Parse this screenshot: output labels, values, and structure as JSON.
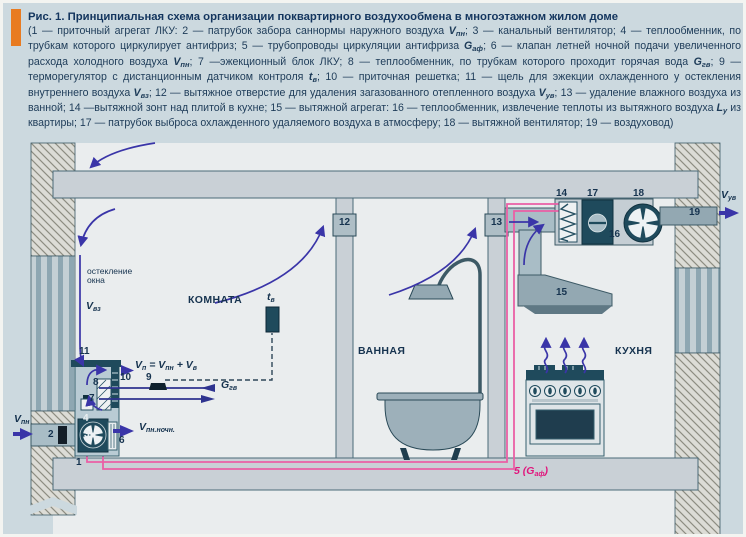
{
  "figure": {
    "title": "Рис. 1. Принципиальная схема организации поквартирного воздухообмена в многоэтажном жилом доме",
    "caption_segments": [
      {
        "s": "p",
        "t": "(1 — приточный агрегат ЛКУ: 2 — патрубок забора саннормы наружного воздуха "
      },
      {
        "s": "v",
        "t": "V"
      },
      {
        "s": "s",
        "t": "пн"
      },
      {
        "s": "p",
        "t": "; 3 — канальный вентилятор; 4 — теплообменник, по трубкам которого циркулирует антифриз; 5 — трубопроводы циркуляции антифриза "
      },
      {
        "s": "v",
        "t": "G"
      },
      {
        "s": "s",
        "t": "аф"
      },
      {
        "s": "p",
        "t": "; 6 — клапан летней ночной подачи увеличенного расхода холодного воздуха "
      },
      {
        "s": "v",
        "t": "V"
      },
      {
        "s": "s",
        "t": "пн"
      },
      {
        "s": "p",
        "t": "; 7 —эжекционный блок ЛКУ; 8 — теплообменник, по трубкам которого проходит горячая вода "
      },
      {
        "s": "v",
        "t": "G"
      },
      {
        "s": "s",
        "t": "гв"
      },
      {
        "s": "p",
        "t": "; 9 — терморегулятор с дистанционным датчиком контроля "
      },
      {
        "s": "v",
        "t": "t"
      },
      {
        "s": "s",
        "t": "в"
      },
      {
        "s": "p",
        "t": "; 10 — приточная решетка; 11 — щель для эжекции охлажденного у остекления внутреннего воздуха "
      },
      {
        "s": "v",
        "t": "V"
      },
      {
        "s": "s",
        "t": "вз"
      },
      {
        "s": "p",
        "t": "; 12 — вытяжное отверстие для удаления загазованного отепленного воздуха "
      },
      {
        "s": "v",
        "t": "V"
      },
      {
        "s": "s",
        "t": "ув"
      },
      {
        "s": "p",
        "t": "; 13 — удаление влажного воздуха из ванной; 14 —вытяжной зонт над плитой в кухне; 15 — вытяжной агрегат: 16 — теплообменник, извлечение теплоты из вытяжного воздуха "
      },
      {
        "s": "v",
        "t": "L"
      },
      {
        "s": "s",
        "t": "у"
      },
      {
        "s": "p",
        "t": " из квартиры; 17 — патрубок выброса охлажденного удаляемого воздуха в атмосферу; 18 — вытяжной вентилятор; 19 — воздуховод)"
      }
    ]
  },
  "colors": {
    "accent_orange": "#e87b21",
    "page_bg": "#ccd9df",
    "room_bg": "#eaedee",
    "slab_fill": "#c9d0d6",
    "dark_teal": "#1f4a5c",
    "arrow_blue": "#3a35a8",
    "pipe_pink": "#ea5fa5",
    "label_magenta": "#e0157c",
    "text_navy": "#16334f"
  },
  "diagram": {
    "labels": [
      {
        "name": "label-v-pn-outdoor",
        "x": 11,
        "y": 411,
        "cls": "var",
        "parts": [
          {
            "s": "v",
            "t": "V"
          },
          {
            "s": "sub",
            "t": "пн"
          }
        ]
      },
      {
        "name": "label-2",
        "x": 45,
        "y": 427,
        "cls": "num",
        "parts": [
          {
            "s": "p",
            "t": "2"
          }
        ]
      },
      {
        "name": "label-1",
        "x": 73,
        "y": 455,
        "cls": "num",
        "parts": [
          {
            "s": "p",
            "t": "1"
          }
        ]
      },
      {
        "name": "label-3",
        "x": 81,
        "y": 427,
        "cls": "num-light",
        "parts": [
          {
            "s": "p",
            "t": "3"
          }
        ]
      },
      {
        "name": "label-4",
        "x": 80,
        "y": 411,
        "cls": "num-light",
        "parts": [
          {
            "s": "p",
            "t": "4"
          }
        ]
      },
      {
        "name": "label-6",
        "x": 116,
        "y": 433,
        "cls": "num",
        "parts": [
          {
            "s": "p",
            "t": "6"
          }
        ]
      },
      {
        "name": "label-7",
        "x": 86,
        "y": 391,
        "cls": "num",
        "parts": [
          {
            "s": "p",
            "t": "7"
          }
        ]
      },
      {
        "name": "label-8",
        "x": 90,
        "y": 375,
        "cls": "num",
        "parts": [
          {
            "s": "p",
            "t": "8"
          }
        ]
      },
      {
        "name": "label-9",
        "x": 143,
        "y": 370,
        "cls": "num",
        "parts": [
          {
            "s": "p",
            "t": "9"
          }
        ]
      },
      {
        "name": "label-10",
        "x": 117,
        "y": 370,
        "cls": "num",
        "parts": [
          {
            "s": "p",
            "t": "10"
          }
        ]
      },
      {
        "name": "label-11",
        "x": 76,
        "y": 344,
        "cls": "num",
        "parts": [
          {
            "s": "p",
            "t": "11"
          }
        ]
      },
      {
        "name": "label-12",
        "x": 336,
        "y": 215,
        "cls": "num",
        "parts": [
          {
            "s": "p",
            "t": "12"
          }
        ]
      },
      {
        "name": "label-13",
        "x": 488,
        "y": 215,
        "cls": "num",
        "parts": [
          {
            "s": "p",
            "t": "13"
          }
        ]
      },
      {
        "name": "label-14",
        "x": 553,
        "y": 186,
        "cls": "num",
        "parts": [
          {
            "s": "p",
            "t": "14"
          }
        ]
      },
      {
        "name": "label-15",
        "x": 553,
        "y": 285,
        "cls": "num",
        "parts": [
          {
            "s": "p",
            "t": "15"
          }
        ]
      },
      {
        "name": "label-16",
        "x": 606,
        "y": 227,
        "cls": "num",
        "parts": [
          {
            "s": "p",
            "t": "16"
          }
        ]
      },
      {
        "name": "label-17",
        "x": 584,
        "y": 186,
        "cls": "num",
        "parts": [
          {
            "s": "p",
            "t": "17"
          }
        ]
      },
      {
        "name": "label-18",
        "x": 630,
        "y": 186,
        "cls": "num",
        "parts": [
          {
            "s": "p",
            "t": "18"
          }
        ]
      },
      {
        "name": "label-19",
        "x": 686,
        "y": 205,
        "cls": "num",
        "parts": [
          {
            "s": "p",
            "t": "19"
          }
        ]
      },
      {
        "name": "label-5-gaf",
        "x": 511,
        "y": 463,
        "cls": "magenta",
        "parts": [
          {
            "s": "p",
            "t": "5 ("
          },
          {
            "s": "v",
            "t": "G"
          },
          {
            "s": "sub",
            "t": "аф"
          },
          {
            "s": "p",
            "t": ")"
          }
        ]
      },
      {
        "name": "label-v-pn-noch",
        "x": 136,
        "y": 419,
        "cls": "var",
        "parts": [
          {
            "s": "v",
            "t": "V"
          },
          {
            "s": "sub",
            "t": "пн.ночн."
          }
        ]
      },
      {
        "name": "label-supply-formula",
        "x": 132,
        "y": 357,
        "cls": "var",
        "parts": [
          {
            "s": "v",
            "t": "V"
          },
          {
            "s": "sub",
            "t": "п"
          },
          {
            "s": "p",
            "t": " = "
          },
          {
            "s": "v",
            "t": "V"
          },
          {
            "s": "sub",
            "t": "пн"
          },
          {
            "s": "p",
            "t": " + "
          },
          {
            "s": "v",
            "t": "V"
          },
          {
            "s": "sub",
            "t": "в"
          }
        ]
      },
      {
        "name": "label-g-gv",
        "x": 218,
        "y": 377,
        "cls": "var",
        "parts": [
          {
            "s": "v",
            "t": "G"
          },
          {
            "s": "sub",
            "t": "гв"
          }
        ]
      },
      {
        "name": "label-v-vz",
        "x": 83,
        "y": 298,
        "cls": "var",
        "parts": [
          {
            "s": "v",
            "t": "V"
          },
          {
            "s": "sub",
            "t": "вз"
          }
        ]
      },
      {
        "name": "label-v-uv",
        "x": 718,
        "y": 187,
        "cls": "var",
        "parts": [
          {
            "s": "v",
            "t": "V"
          },
          {
            "s": "sub",
            "t": "ув"
          }
        ]
      },
      {
        "name": "label-t-v",
        "x": 264,
        "y": 289,
        "cls": "var",
        "parts": [
          {
            "s": "v",
            "t": "t"
          },
          {
            "s": "sub",
            "t": "в"
          }
        ]
      },
      {
        "name": "label-glazing",
        "x": 84,
        "y": 264,
        "cls": "small",
        "parts": [
          {
            "s": "p",
            "t": "остекление\nокна"
          }
        ]
      },
      {
        "name": "label-room-komnata",
        "x": 185,
        "y": 292,
        "cls": "room",
        "parts": [
          {
            "s": "p",
            "t": "КОМНАТА"
          }
        ]
      },
      {
        "name": "label-room-vannaya",
        "x": 355,
        "y": 343,
        "cls": "room",
        "parts": [
          {
            "s": "p",
            "t": "ВАННАЯ"
          }
        ]
      },
      {
        "name": "label-room-kuhnya",
        "x": 612,
        "y": 343,
        "cls": "room",
        "parts": [
          {
            "s": "p",
            "t": "КУХНЯ"
          }
        ]
      }
    ]
  }
}
